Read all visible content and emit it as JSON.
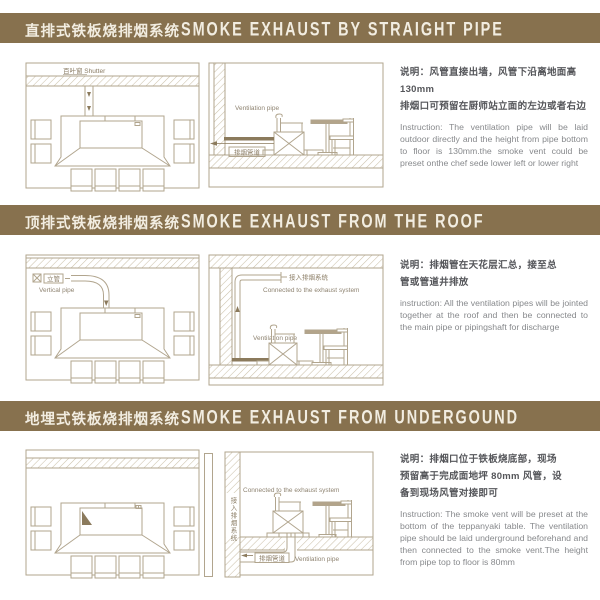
{
  "colors": {
    "bar_background": "#87714e",
    "bar_text": "#f2ede1",
    "diagram_line": "#b1a58e",
    "pipe_dark": "#8b7a5c",
    "diagram_label": "#8a7c64",
    "instruction_zh_text": "#55565a",
    "instruction_en_text": "#87898c"
  },
  "sections": [
    {
      "title_zh": "直排式铁板烧排烟系统",
      "title_en": "SMOKE EXHAUST BY STRAIGHT PIPE",
      "labels": {
        "shutter": "百叶窗 Shutter",
        "vent_pipe_en": "Ventilation pipe",
        "vent_pipe_zh": "排烟管道"
      },
      "desc_zh": "说明：风管直接出墙，风管下沿离地面高\n130mm\n排烟口可预留在厨师站立面的左边或者右边",
      "desc_en": "Instruction: The ventilation pipe will be laid outdoor directly and the height from pipe bottom to floor is 130mm.the smoke vent could be preset onthe chef sede lower left or lower right"
    },
    {
      "title_zh": "顶排式铁板烧排烟系统",
      "title_en": "SMOKE EXHAUST FROM THE ROOF",
      "labels": {
        "vertical_pipe_zh": "立管",
        "vertical_pipe_en": "Vertical pipe",
        "connect_zh": "接入排烟系统",
        "connect_en": "Connected to the exhaust system",
        "vent_pipe_en": "Ventilation pipe"
      },
      "desc_zh": "说明：排烟管在天花层汇总，接至总\n管或管道井排放",
      "desc_en": "instruction: All the ventilation pipes will be jointed together at the roof and then be connected to the main pipe or pipingshaft for discharge"
    },
    {
      "title_zh": "地埋式铁板烧排烟系统",
      "title_en": "SMOKE EXHAUST FROM UNDERGOUND",
      "labels": {
        "connect_zh": "接入排烟系统",
        "connect_en": "Connected to the exhaust system",
        "vent_pipe_zh": "排烟管道",
        "vent_pipe_en": "Ventilation pipe"
      },
      "desc_zh": "说明：排烟口位于铁板烧底部，现场\n预留高于完成面地坪 80mm 风管，设\n备到现场风管对接即可",
      "desc_en": "Instruction: The smoke vent will be preset at the bottom of the teppanyaki table. The ventilation pipe should be laid underground beforehand and then connected to the smoke vent.The height from pipe top to floor is 80mm"
    }
  ]
}
